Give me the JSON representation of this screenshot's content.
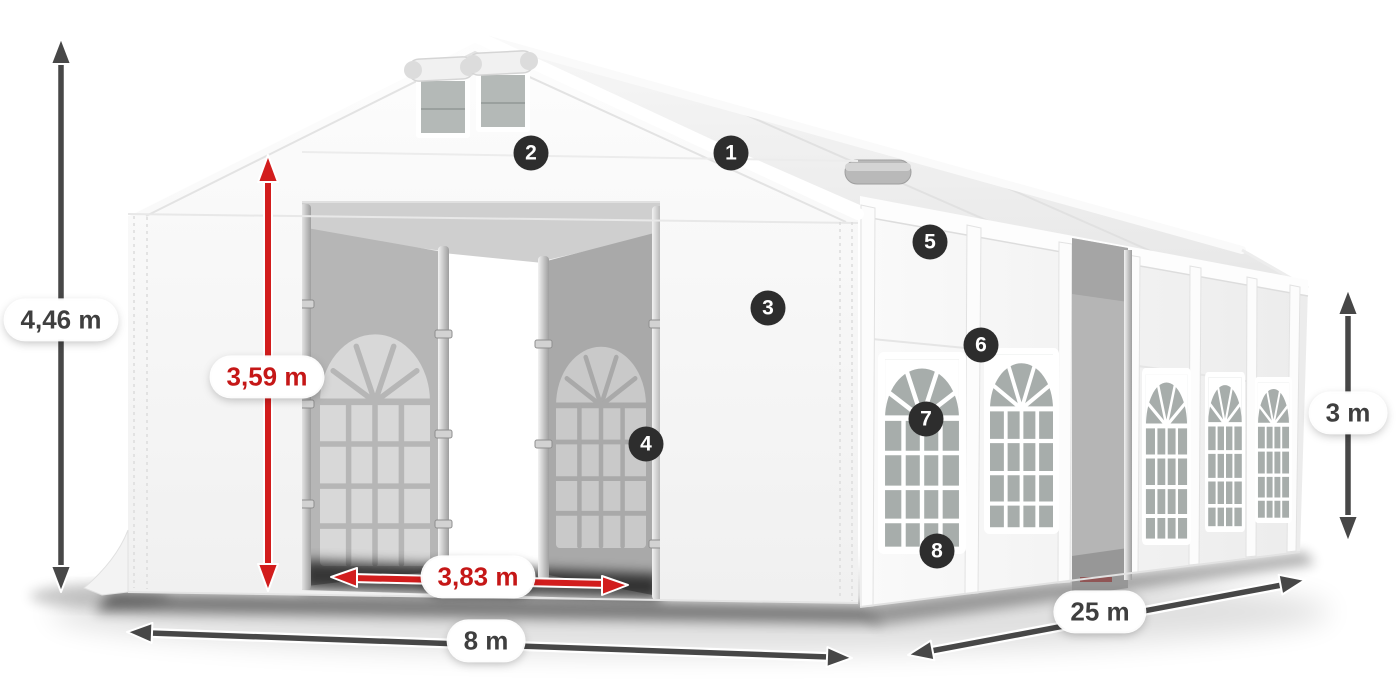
{
  "dimensions": {
    "total_height": {
      "label": "4,46 m",
      "style": "gray",
      "orientation": "vertical"
    },
    "entrance_height": {
      "label": "3,59 m",
      "style": "red",
      "orientation": "vertical"
    },
    "entrance_width": {
      "label": "3,83 m",
      "style": "red",
      "orientation": "horizontal"
    },
    "front_width": {
      "label": "8 m",
      "style": "gray",
      "orientation": "horizontal"
    },
    "side_length": {
      "label": "25 m",
      "style": "gray",
      "orientation": "diagonal"
    },
    "wall_height": {
      "label": "3 m",
      "style": "gray",
      "orientation": "vertical"
    }
  },
  "markers": [
    {
      "label": "1"
    },
    {
      "label": "2"
    },
    {
      "label": "3"
    },
    {
      "label": "4"
    },
    {
      "label": "5"
    },
    {
      "label": "6"
    },
    {
      "label": "7"
    },
    {
      "label": "8"
    }
  ],
  "colors": {
    "dimension_arrow_gray": "#474747",
    "dimension_arrow_red": "#d21d1d",
    "dimension_text_gray": "#3f3f3f",
    "dimension_text_red": "#c51717",
    "label_background": "#ffffff",
    "marker_background": "#2d2d2d",
    "marker_text": "#ffffff",
    "tent_fabric": "#f8f8f8",
    "window_glass": "#a7adab",
    "interior_panel": "#b0b0b0",
    "ground_shadow": "#1a1a1a"
  }
}
